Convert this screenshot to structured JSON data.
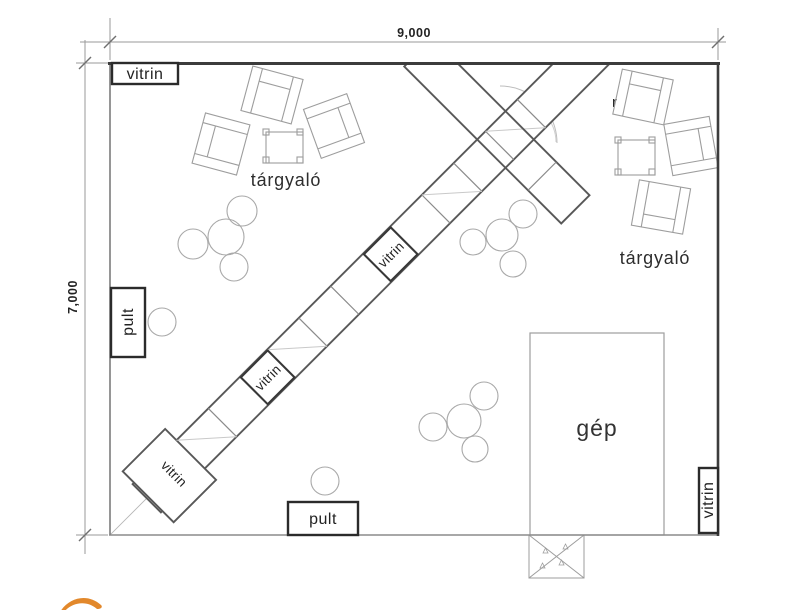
{
  "plan": {
    "dimensions": {
      "width_label": "9,000",
      "height_label": "7,000"
    },
    "labels": {
      "vitrin_top_left": "vitrin",
      "vitrin_corridor_upper": "vitrin",
      "vitrin_corridor_lower": "vitrin",
      "vitrin_corridor_end": "vitrin",
      "vitrin_right_wall": "vitrin",
      "pult_left": "pult",
      "pult_bottom": "pult",
      "meeting_room_left": "tárgyaló",
      "meeting_room_right": "tárgyaló",
      "machine": "gép",
      "truncated_text": "r"
    },
    "colors": {
      "logo_orange": "#E2882B",
      "wall_dark": "#3C3C3C"
    }
  }
}
